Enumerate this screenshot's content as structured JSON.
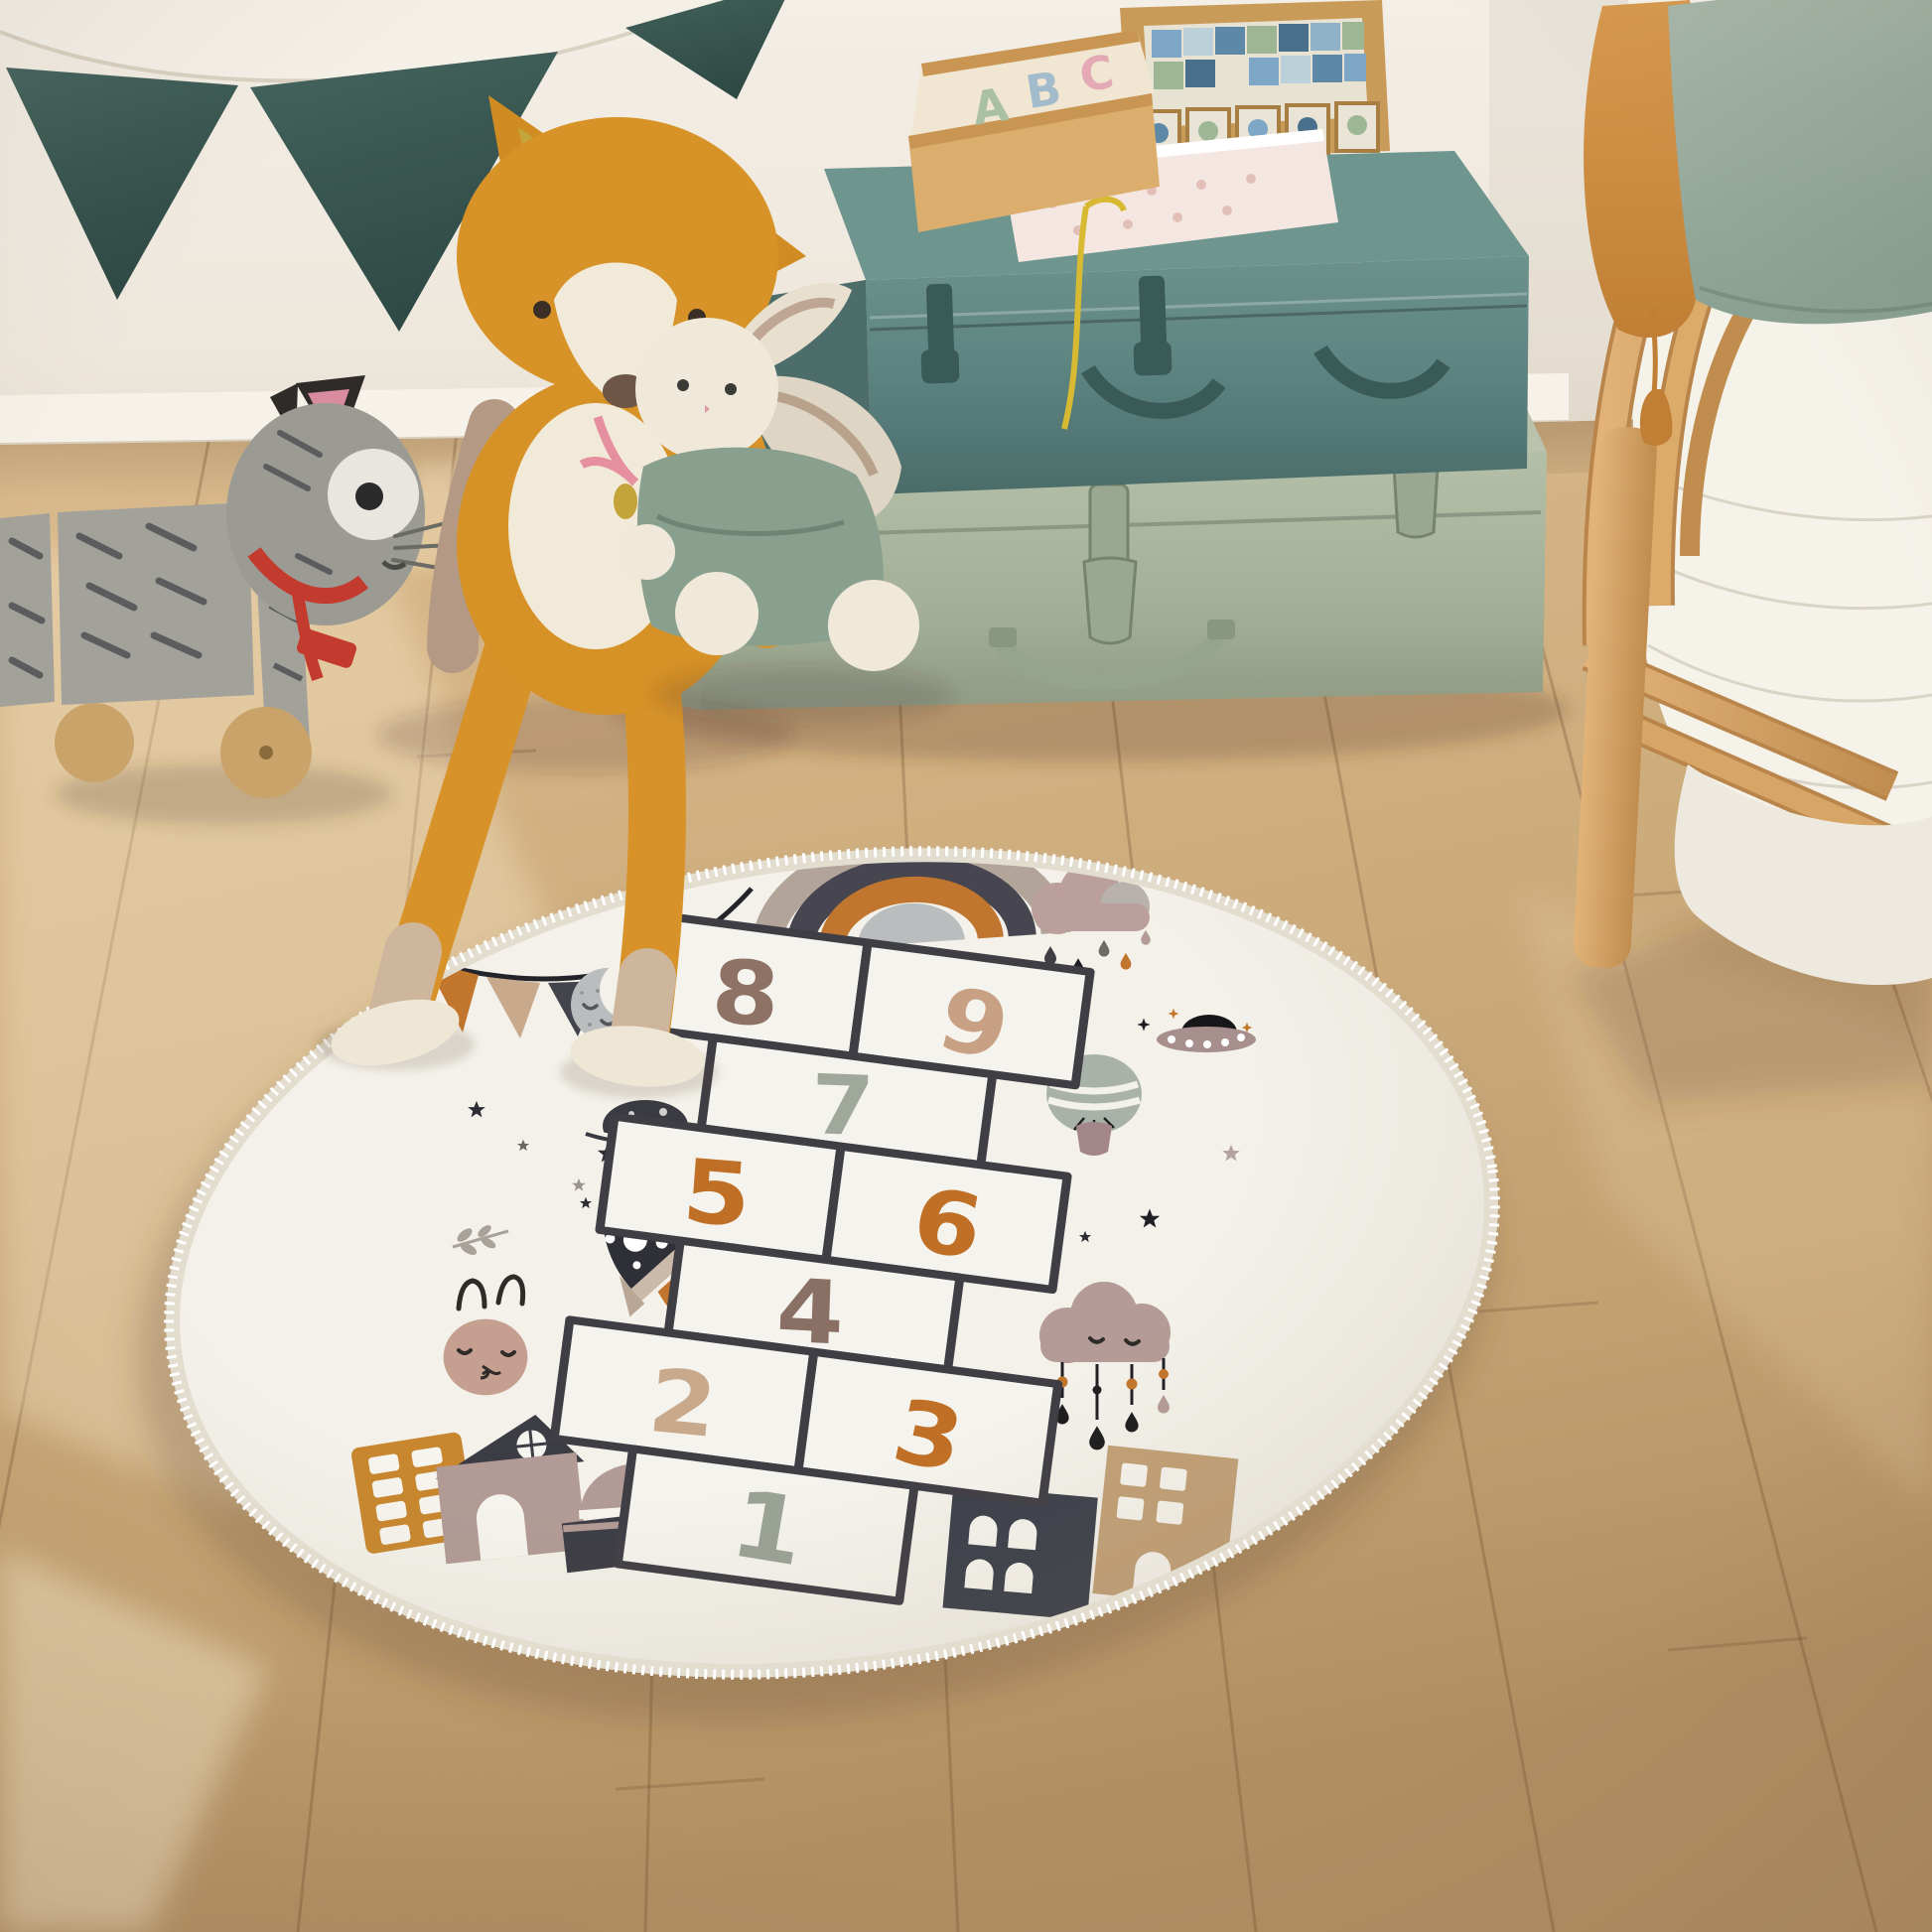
{
  "rug": {
    "numbers": [
      {
        "value": "1",
        "color": "#9aa296"
      },
      {
        "value": "2",
        "color": "#c9a98c"
      },
      {
        "value": "3",
        "color": "#c07026"
      },
      {
        "value": "4",
        "color": "#8a7064"
      },
      {
        "value": "5",
        "color": "#c07026"
      },
      {
        "value": "6",
        "color": "#c07026"
      },
      {
        "value": "7",
        "color": "#9fa89a"
      },
      {
        "value": "8",
        "color": "#8d7265"
      },
      {
        "value": "9",
        "color": "#c8a084"
      }
    ],
    "base_color": "#f3f1ea",
    "grid_color": "#3f3e45",
    "fringe_color": "#ffffff"
  },
  "toy_box": {
    "letters": [
      {
        "char": "A",
        "color": "#a9c0a2"
      },
      {
        "char": "B",
        "color": "#a3bccb"
      },
      {
        "char": "C",
        "color": "#e3aab6"
      }
    ]
  },
  "palette": {
    "wall": "#f1ebe3",
    "baseboard": "#f7f2e9",
    "floor": "#cdac7e",
    "bunting_teal": "#3d5a55",
    "trunk_teal": "#5c8380",
    "trunk_sage": "#aab59f",
    "rattan": "#d9a765",
    "cushion_ochre": "#cf8c41",
    "pillow_sage": "#9fb1a3",
    "fox_orange": "#d69127",
    "cat_gray": "#9b9b93",
    "accent_orange": "#c2762d",
    "accent_tan": "#c9a98c",
    "accent_charcoal": "#44444c",
    "accent_mauve": "#b49b97"
  }
}
